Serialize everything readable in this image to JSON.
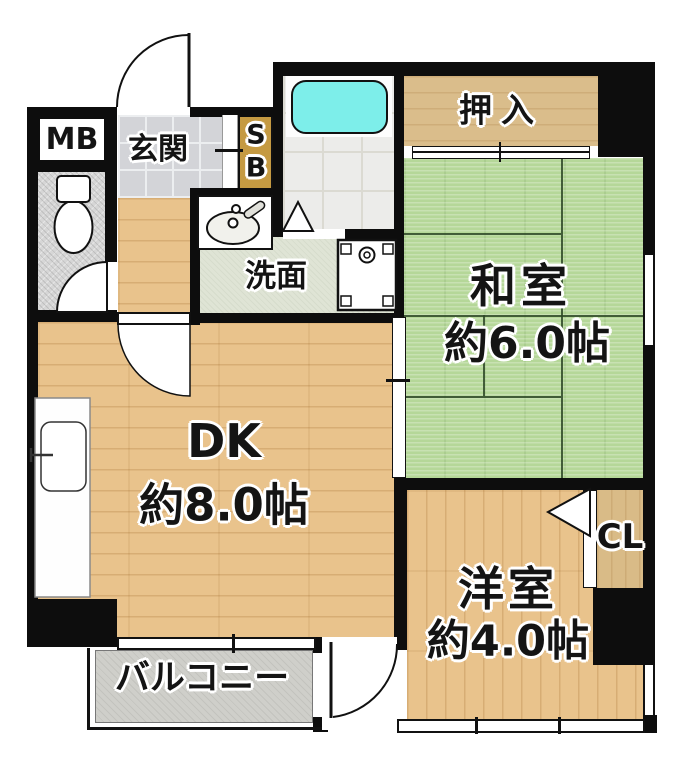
{
  "plan": {
    "mb_label": "MB",
    "genkan_label": "玄関",
    "sb_line1": "S",
    "sb_line2": "B",
    "oshiire_label": "押入",
    "washitsu_label": "和室",
    "washitsu_size": "約6.0帖",
    "senmen_label": "洗面",
    "dk_label": "DK",
    "dk_size": "約8.0帖",
    "yoshitsu_label": "洋室",
    "yoshitsu_size": "約4.0帖",
    "cl_label": "CL",
    "balcony_label": "バルコニー"
  },
  "colors": {
    "wall": "#0d0d0d",
    "wood_floor": "#e9c38c",
    "tatami": "#b5d798",
    "closet_wood": "#dabd8b",
    "sb_wood": "#c59a42",
    "entry_tile": "#d3d4d8",
    "washroom_floor": "#dfe4d5",
    "bath_floor": "#ececea",
    "bathtub": "#7deeea",
    "balcony_floor": "#cfcfca",
    "toilet_floor": "#d6d6d6"
  }
}
